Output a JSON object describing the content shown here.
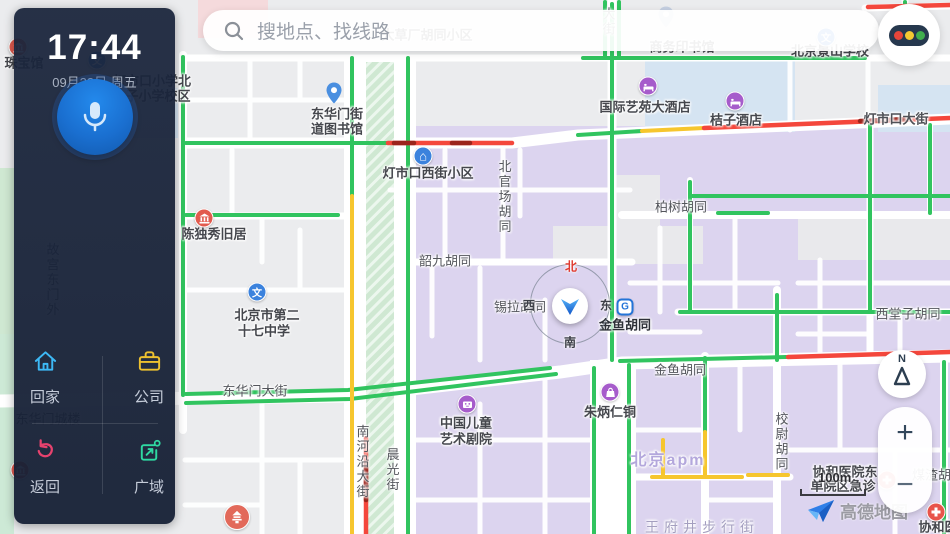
{
  "sidebar": {
    "time": "17:44",
    "date": "09月23日 周五",
    "actions": [
      {
        "label": "回家"
      },
      {
        "label": "公司"
      },
      {
        "label": "返回"
      },
      {
        "label": "广域"
      }
    ]
  },
  "search": {
    "placeholder": "搜地点、找线路"
  },
  "traffic_button": {
    "colors": {
      "red": "#e5453a",
      "yellow": "#f3c832",
      "green": "#3fae4d"
    }
  },
  "controls": {
    "compass_n": "N",
    "zoom_in": "+",
    "zoom_out": "−",
    "scale": "100m"
  },
  "logo": {
    "text": "高德地图"
  },
  "location_puck": {
    "north": "北",
    "south": "南",
    "east": "东",
    "west": "西"
  },
  "map": {
    "traffic_colors": {
      "green": "#31c45f",
      "yellow": "#f6c62e",
      "red": "#f4473c",
      "dark_red": "#9b241c"
    },
    "block_colors": {
      "base": "#ebecee",
      "residential": "#dcd4ef",
      "school": "#d5e4f2",
      "park": "#cfe8d2",
      "pink": "#f5dadc"
    },
    "labels": [
      {
        "t": "商务印书馆",
        "x": 682,
        "y": 48,
        "c": "poi"
      },
      {
        "t": "大草厂胡同小区",
        "x": 427,
        "y": 36,
        "c": "poi"
      },
      {
        "t": "大街",
        "x": 607,
        "y": 22,
        "c": "street",
        "v": true
      },
      {
        "t": "北京景山学校",
        "x": 830,
        "y": 52,
        "c": "poi"
      },
      {
        "t": "国际艺苑大酒店",
        "x": 645,
        "y": 108,
        "c": "poi"
      },
      {
        "t": "桔子酒店",
        "x": 736,
        "y": 121,
        "c": "poi"
      },
      {
        "t": "灯市口大街",
        "x": 896,
        "y": 120,
        "c": "onroad"
      },
      {
        "t": "灯市口西街小区",
        "x": 428,
        "y": 174,
        "c": "poi"
      },
      {
        "t": "东华门街",
        "x": 337,
        "y": 115,
        "c": "poi"
      },
      {
        "t": "道图书馆",
        "x": 337,
        "y": 130,
        "c": "poi"
      },
      {
        "t": "北官场胡同",
        "x": 503,
        "y": 197,
        "c": "street",
        "v": true
      },
      {
        "t": "柏树胡同",
        "x": 681,
        "y": 208,
        "c": "street"
      },
      {
        "t": "韶九胡同",
        "x": 445,
        "y": 262,
        "c": "street"
      },
      {
        "t": "陈独秀旧居",
        "x": 214,
        "y": 235,
        "c": "poi"
      },
      {
        "t": "北京市第二",
        "x": 267,
        "y": 316,
        "c": "poi"
      },
      {
        "t": "十七中学",
        "x": 264,
        "y": 332,
        "c": "poi"
      },
      {
        "t": "锡拉胡同",
        "x": 520,
        "y": 308,
        "c": "street"
      },
      {
        "t": "金鱼胡同",
        "x": 625,
        "y": 326,
        "c": "station"
      },
      {
        "t": "金鱼胡同",
        "x": 680,
        "y": 371,
        "c": "street"
      },
      {
        "t": "西堂子胡同",
        "x": 908,
        "y": 315,
        "c": "street"
      },
      {
        "t": "东华门大街",
        "x": 255,
        "y": 392,
        "c": "street"
      },
      {
        "t": "南河沿大街",
        "x": 361,
        "y": 462,
        "c": "street",
        "v": true
      },
      {
        "t": "晨光街",
        "x": 391,
        "y": 470,
        "c": "street",
        "v": true
      },
      {
        "t": "中国儿童",
        "x": 466,
        "y": 424,
        "c": "poi"
      },
      {
        "t": "艺术剧院",
        "x": 466,
        "y": 440,
        "c": "poi"
      },
      {
        "t": "朱炳仁铜",
        "x": 610,
        "y": 413,
        "c": "poi"
      },
      {
        "t": "北京apm",
        "x": 668,
        "y": 461,
        "c": "district"
      },
      {
        "t": "校尉胡同",
        "x": 780,
        "y": 442,
        "c": "street",
        "v": true
      },
      {
        "t": "协和医院东",
        "x": 845,
        "y": 473,
        "c": "poi"
      },
      {
        "t": "单院区急诊",
        "x": 843,
        "y": 487,
        "c": "poi"
      },
      {
        "t": "王府井步行街",
        "x": 702,
        "y": 527,
        "c": "ped"
      },
      {
        "t": "煤渣胡同",
        "x": 938,
        "y": 476,
        "c": "street"
      },
      {
        "t": "协和医",
        "x": 938,
        "y": 528,
        "c": "poi"
      },
      {
        "t": "灯市口小学北",
        "x": 152,
        "y": 82,
        "c": "poi"
      },
      {
        "t": "子小学校区",
        "x": 158,
        "y": 97,
        "c": "poi"
      },
      {
        "t": "珠宝馆",
        "x": 24,
        "y": 64,
        "c": "poi"
      },
      {
        "t": "故宫东门外",
        "x": 51,
        "y": 280,
        "c": "street",
        "v": true
      },
      {
        "t": "东华门城楼",
        "x": 48,
        "y": 420,
        "c": "street"
      }
    ],
    "icons": [
      {
        "k": "pin",
        "x": 334,
        "y": 96
      },
      {
        "k": "pin-faint",
        "x": 666,
        "y": 20
      },
      {
        "k": "school",
        "x": 257,
        "y": 292
      },
      {
        "k": "school",
        "x": 826,
        "y": 37
      },
      {
        "k": "school",
        "x": 97,
        "y": 60
      },
      {
        "k": "community",
        "x": 423,
        "y": 156
      },
      {
        "k": "hotel",
        "x": 648,
        "y": 86
      },
      {
        "k": "hotel",
        "x": 735,
        "y": 101
      },
      {
        "k": "museum",
        "x": 204,
        "y": 218
      },
      {
        "k": "museum",
        "x": 18,
        "y": 47
      },
      {
        "k": "museum",
        "x": 20,
        "y": 470
      },
      {
        "k": "shop",
        "x": 610,
        "y": 392
      },
      {
        "k": "theater",
        "x": 467,
        "y": 404
      },
      {
        "k": "subway",
        "x": 625,
        "y": 307
      },
      {
        "k": "hospital",
        "x": 887,
        "y": 480
      },
      {
        "k": "hospital",
        "x": 936,
        "y": 512
      },
      {
        "k": "pagoda",
        "x": 237,
        "y": 517
      }
    ]
  }
}
